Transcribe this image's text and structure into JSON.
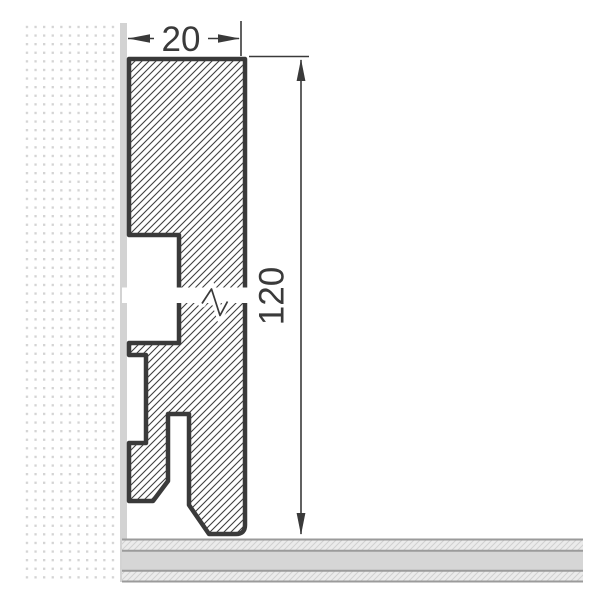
{
  "drawing": {
    "subject": "skirting-board-profile-cross-section",
    "labels": {
      "width": "20",
      "height": "120"
    }
  },
  "colors": {
    "bg": "#ffffff",
    "line": "#3a3a3a",
    "hatch": "#3f3f3f",
    "wall_dot": "#d4d4d4",
    "wall_strip": "#d3d3d3",
    "floor_light": "#ebebeb",
    "floor_mid": "#d6d6d6",
    "floor_line": "#9b9b9b",
    "floor_hatch": "#d0d0d0"
  }
}
